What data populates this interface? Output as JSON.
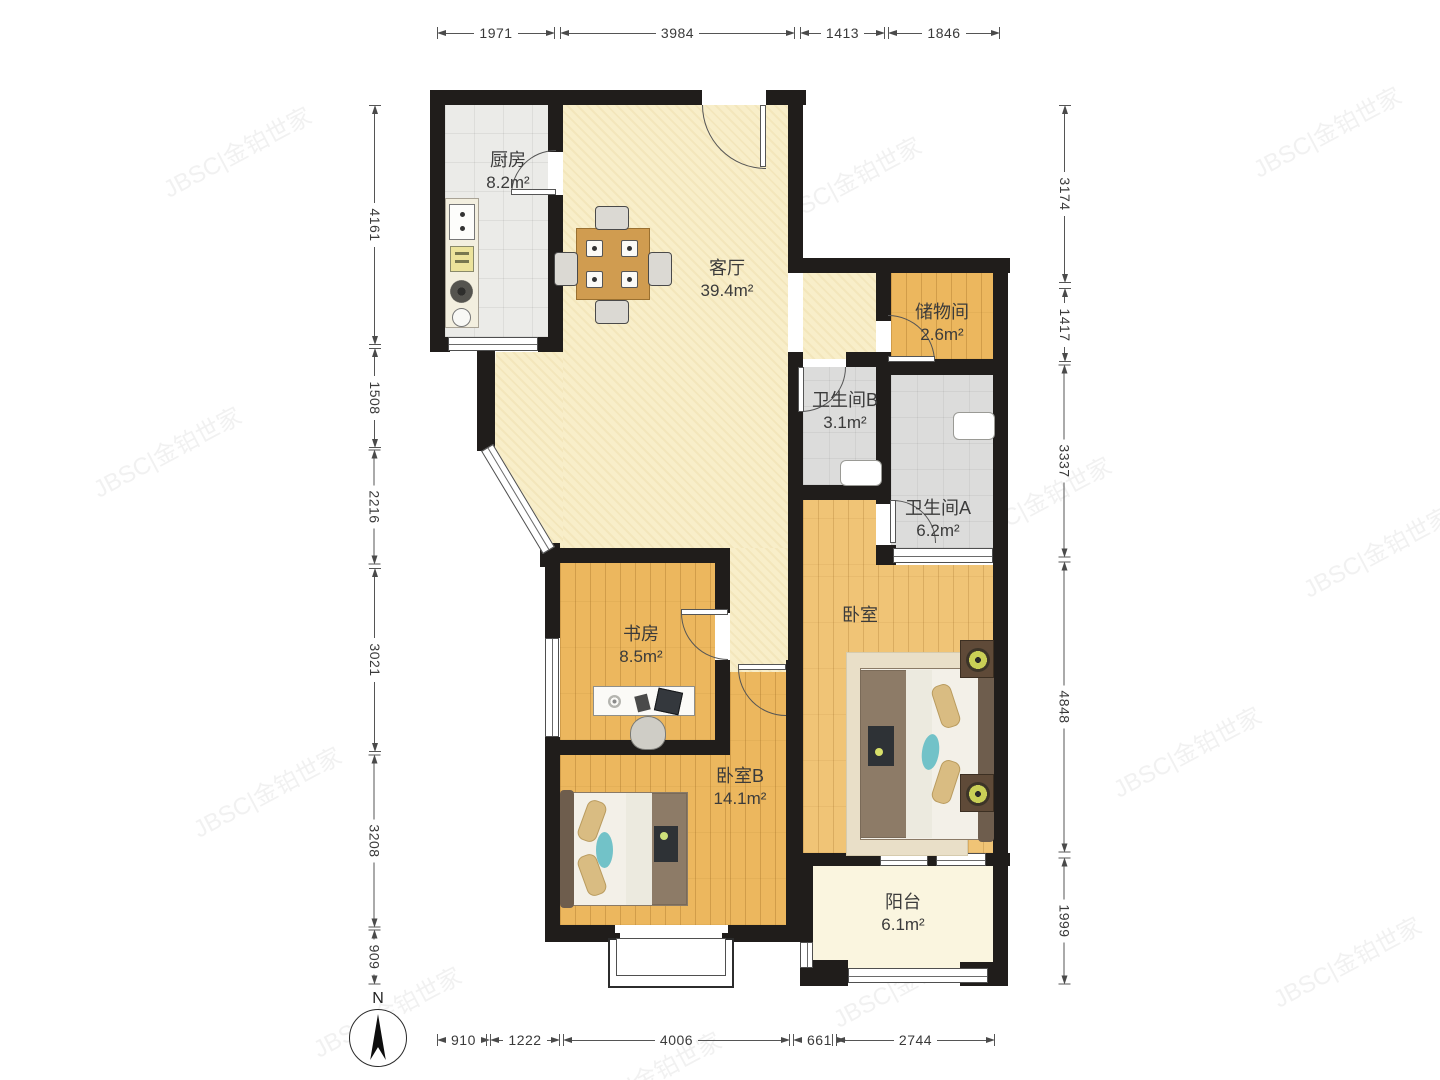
{
  "title": "户型图",
  "compass": {
    "north_label": "N"
  },
  "watermark": {
    "text": "JBSC|金铂世家"
  },
  "rooms": {
    "kitchen": {
      "name": "厨房",
      "area": "8.2m²"
    },
    "living": {
      "name": "客厅",
      "area": "39.4m²"
    },
    "storage": {
      "name": "储物间",
      "area": "2.6m²"
    },
    "bath_b": {
      "name": "卫生间B",
      "area": "3.1m²"
    },
    "bath_a": {
      "name": "卫生间A",
      "area": "6.2m²"
    },
    "study": {
      "name": "书房",
      "area": "8.5m²"
    },
    "bedroom": {
      "name": "卧室",
      "area": ""
    },
    "bedroom_b": {
      "name": "卧室B",
      "area": "14.1m²"
    },
    "balcony": {
      "name": "阳台",
      "area": "6.1m²"
    }
  },
  "dimensions": {
    "top": [
      "1971",
      "3984",
      "1413",
      "1846"
    ],
    "bottom": [
      "910",
      "1222",
      "4006",
      "661",
      "2744"
    ],
    "left": [
      "4161",
      "1508",
      "2216",
      "3021",
      "3208",
      "909"
    ],
    "right": [
      "3174",
      "1417",
      "3337",
      "4848",
      "1999"
    ]
  },
  "colors": {
    "wall": "#201d1b",
    "wood_floor": "#ecb75e",
    "living_floor": "#f8eec9",
    "tile_floor": "#ebebe8",
    "bath_floor": "#dcdcdb",
    "balcony_floor": "#faf5df",
    "dimension_line": "#555555"
  }
}
